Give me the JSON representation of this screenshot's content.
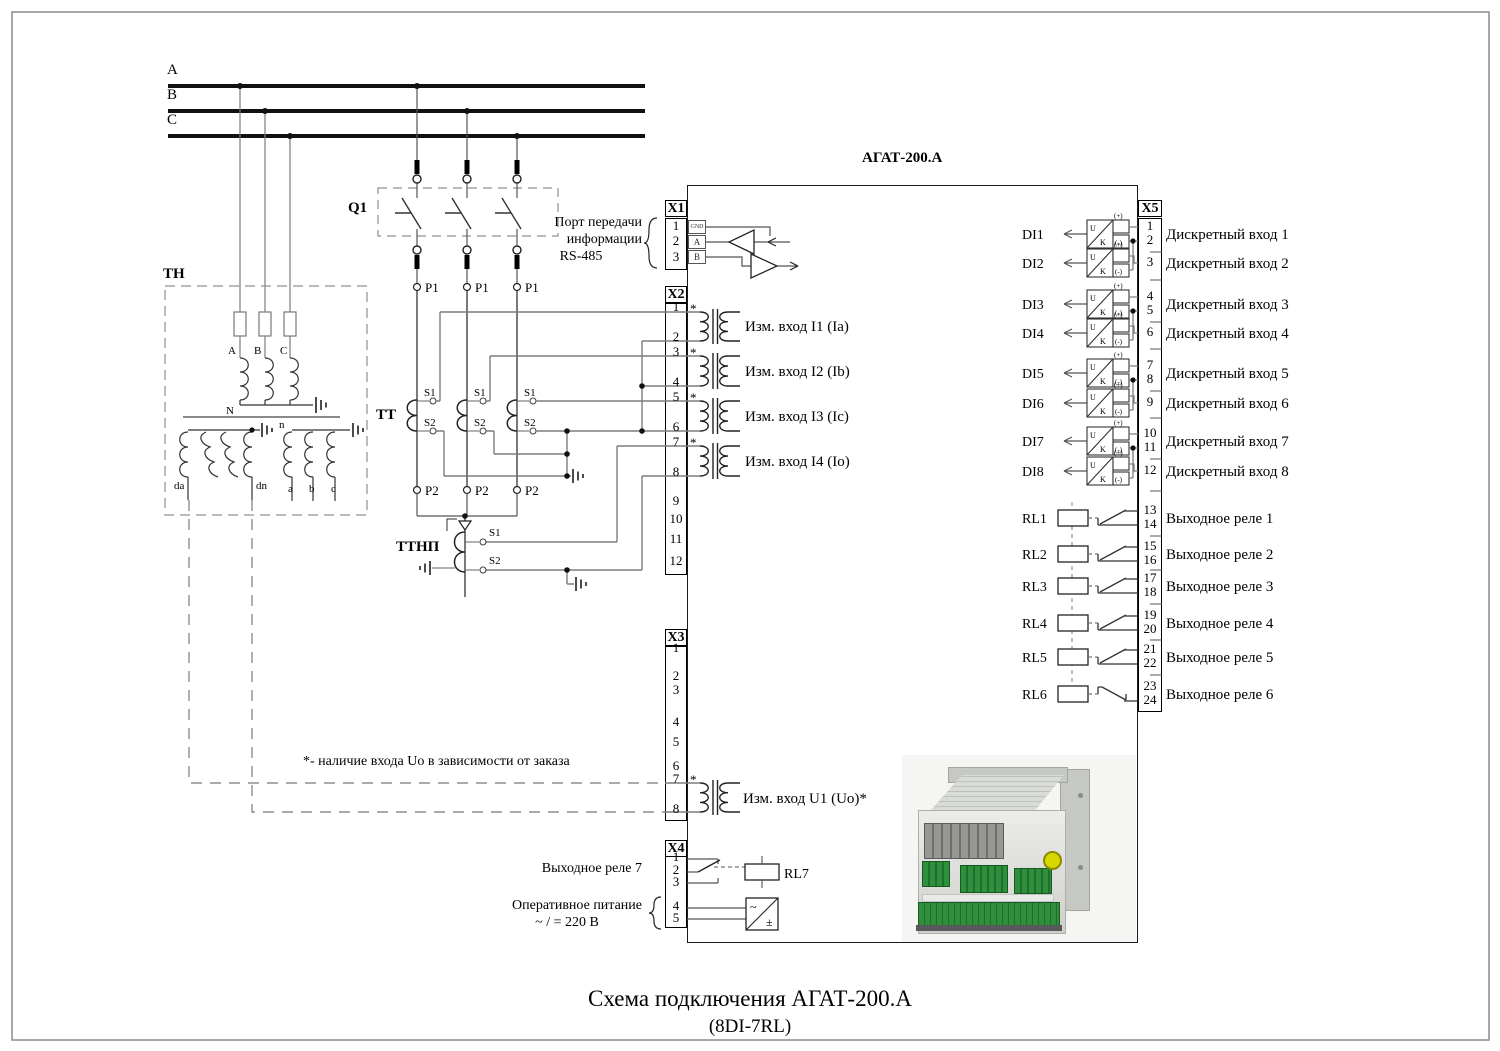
{
  "title": {
    "line1": "Схема подключения АГАТ-200.А",
    "line2": "(8DI-7RL)"
  },
  "device_name": "АГАТ-200.А",
  "buses": {
    "a": "A",
    "b": "B",
    "c": "C"
  },
  "breaker": "Q1",
  "vt": {
    "name": "ТН",
    "phase_a": "A",
    "phase_b": "B",
    "phase_c": "C",
    "neutral": "N",
    "sec_neutral": "n",
    "da": "da",
    "dn": "dn",
    "a": "a",
    "b": "b",
    "c": "c"
  },
  "ct": {
    "name": "ТТ",
    "p1": "P1",
    "p2": "P2",
    "s1": "S1",
    "s2": "S2"
  },
  "ct_zero": {
    "name": "ТТНП",
    "s1": "S1",
    "s2": "S2"
  },
  "port": {
    "line1": "Порт передачи",
    "line2": "информации",
    "line3": "RS-485"
  },
  "note": "*- наличие входа Uo в зависимости от заказа",
  "asterisk": "*",
  "x1": {
    "header": "X1",
    "terminals": [
      "1",
      "2",
      "3"
    ],
    "pins": [
      "GND",
      "A",
      "B"
    ]
  },
  "x2": {
    "header": "X2",
    "terminals": [
      "1",
      "2",
      "3",
      "4",
      "5",
      "6",
      "7",
      "8",
      "9",
      "10",
      "11",
      "12"
    ],
    "inputs": [
      "Изм. вход I1 (Ia)",
      "Изм. вход I2 (Ib)",
      "Изм. вход I3 (Ic)",
      "Изм. вход I4 (Io)"
    ]
  },
  "x3": {
    "header": "X3",
    "terminals": [
      "1",
      "2",
      "3",
      "4",
      "5",
      "6",
      "7",
      "8"
    ],
    "input": "Изм. вход U1 (Uo)*"
  },
  "x4": {
    "header": "X4",
    "terminals": [
      "1",
      "2",
      "3",
      "4",
      "5"
    ],
    "relay_label": "Выходное реле 7",
    "relay_tag": "RL7",
    "power_line1": "Оперативное питание",
    "power_line2": "~ / = 220 В"
  },
  "x5": {
    "header": "X5",
    "terminals": [
      "1",
      "2",
      "3",
      "4",
      "5",
      "6",
      "7",
      "8",
      "9",
      "10",
      "11",
      "12",
      "13",
      "14",
      "15",
      "16",
      "17",
      "18",
      "19",
      "20",
      "21",
      "22",
      "23",
      "24"
    ],
    "di": [
      {
        "tag": "DI1",
        "label": "Дискретный вход 1"
      },
      {
        "tag": "DI2",
        "label": "Дискретный вход 2"
      },
      {
        "tag": "DI3",
        "label": "Дискретный вход 3"
      },
      {
        "tag": "DI4",
        "label": "Дискретный вход 4"
      },
      {
        "tag": "DI5",
        "label": "Дискретный вход 5"
      },
      {
        "tag": "DI6",
        "label": "Дискретный вход 6"
      },
      {
        "tag": "DI7",
        "label": "Дискретный вход 7"
      },
      {
        "tag": "DI8",
        "label": "Дискретный вход 8"
      }
    ],
    "rl": [
      {
        "tag": "RL1",
        "label": "Выходное реле 1"
      },
      {
        "tag": "RL2",
        "label": "Выходное реле 2"
      },
      {
        "tag": "RL3",
        "label": "Выходное реле 3"
      },
      {
        "tag": "RL4",
        "label": "Выходное реле 4"
      },
      {
        "tag": "RL5",
        "label": "Выходное реле 5"
      },
      {
        "tag": "RL6",
        "label": "Выходное реле 6"
      }
    ]
  },
  "opto": {
    "plus": "(+)",
    "minus": "(-)",
    "u": "U",
    "k": "K"
  },
  "psu": {
    "ac": "~",
    "dc": "±"
  },
  "colors": {
    "wire_gray": "#7d7d7d",
    "line_black": "#1a1a1a",
    "terminal_green": "#2f8f3c",
    "ground_yellow": "#d8d800"
  }
}
